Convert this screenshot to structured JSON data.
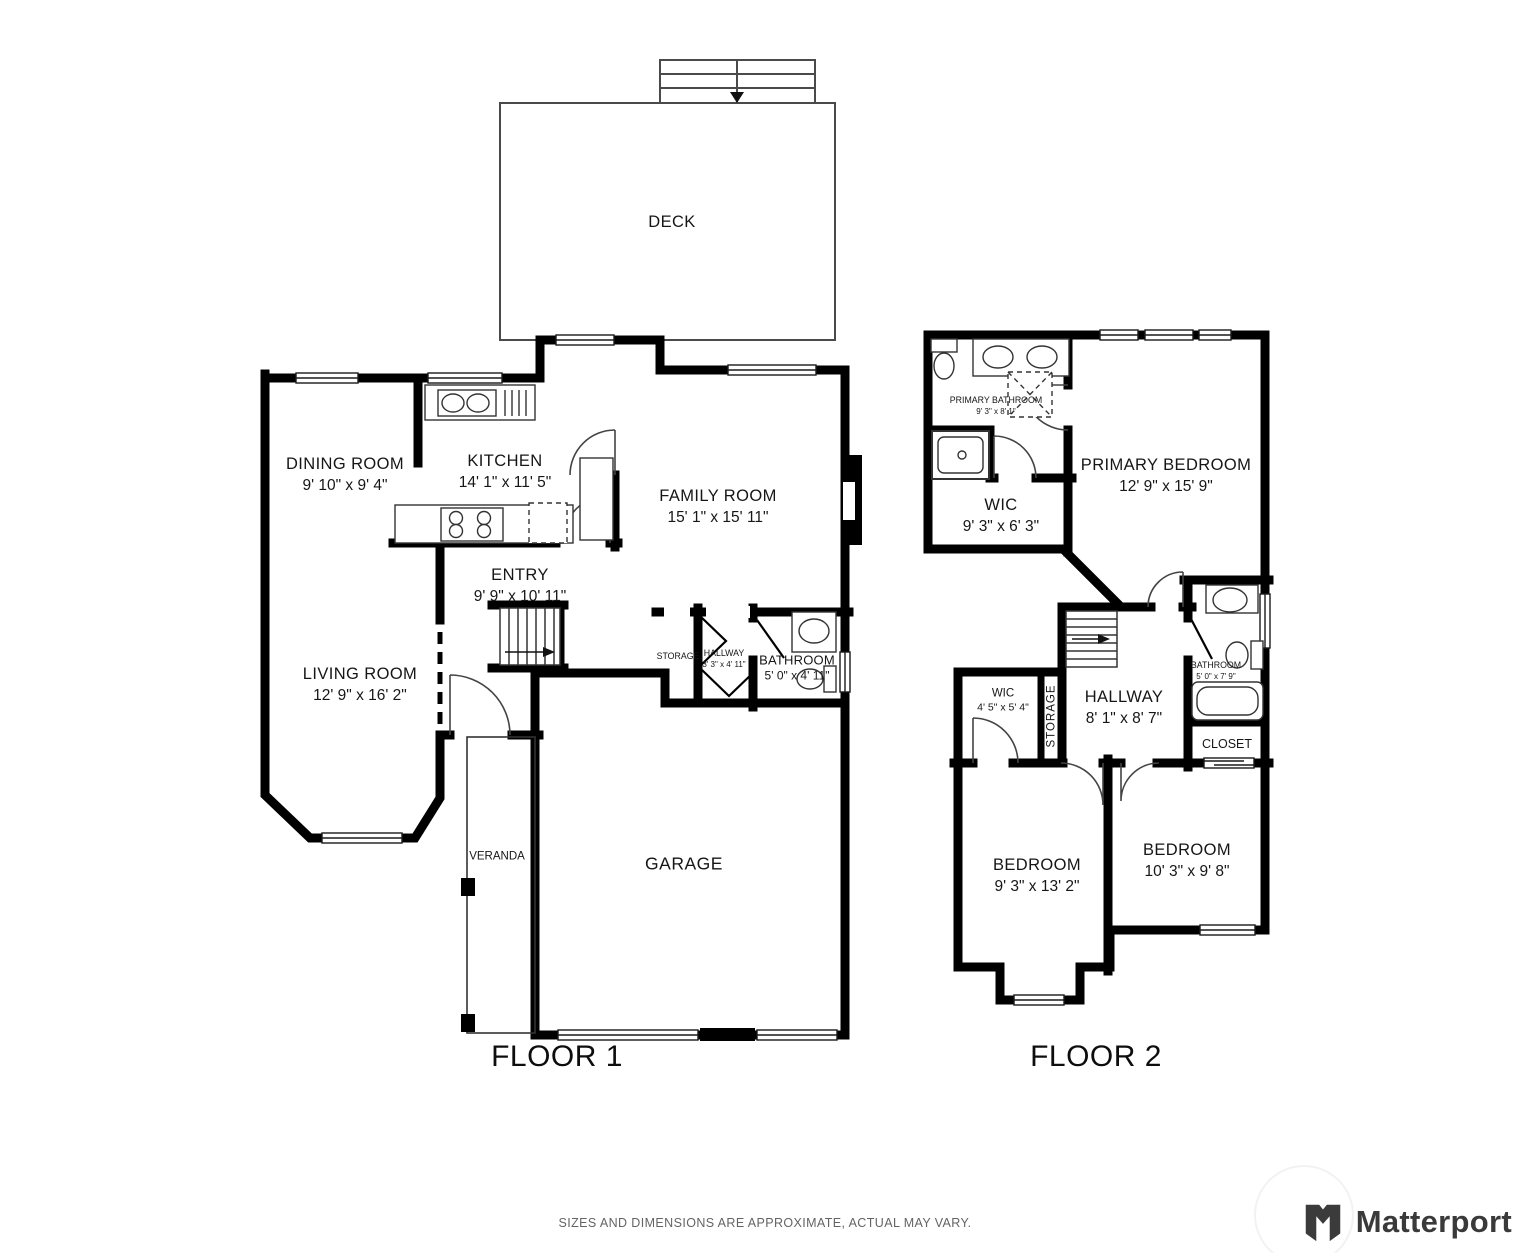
{
  "meta": {
    "disclaimer": "SIZES AND DIMENSIONS ARE APPROXIMATE, ACTUAL MAY VARY.",
    "brand": "Matterport",
    "wall_color": "#000000",
    "background_color": "#ffffff",
    "label_color": "#161616",
    "disclaimer_color": "#646464"
  },
  "floor1": {
    "title": "FLOOR 1",
    "rooms": {
      "deck": {
        "name": "DECK",
        "dims": ""
      },
      "dining": {
        "name": "DINING ROOM",
        "dims": "9' 10\" x 9' 4\""
      },
      "kitchen": {
        "name": "KITCHEN",
        "dims": "14' 1\" x 11' 5\""
      },
      "family": {
        "name": "FAMILY ROOM",
        "dims": "15' 1\" x 15' 11\""
      },
      "entry": {
        "name": "ENTRY",
        "dims": "9' 9\" x 10' 11\""
      },
      "living": {
        "name": "LIVING ROOM",
        "dims": "12' 9\" x 16' 2\""
      },
      "storage": {
        "name": "STORAGE",
        "dims": ""
      },
      "hallway": {
        "name": "HALLWAY",
        "dims": "3' 3\" x 4' 11\""
      },
      "bathroom": {
        "name": "BATHROOM",
        "dims": "5' 0\" x 4' 11\""
      },
      "veranda": {
        "name": "VERANDA",
        "dims": ""
      },
      "garage": {
        "name": "GARAGE",
        "dims": ""
      }
    }
  },
  "floor2": {
    "title": "FLOOR 2",
    "rooms": {
      "primary_bathroom": {
        "name": "PRIMARY BATHROOM",
        "dims": "9' 3\" x 8' 1\""
      },
      "primary_bedroom": {
        "name": "PRIMARY BEDROOM",
        "dims": "12' 9\" x 15' 9\""
      },
      "wic_large": {
        "name": "WIC",
        "dims": "9' 3\" x 6' 3\""
      },
      "wic_small": {
        "name": "WIC",
        "dims": "4' 5\" x 5' 4\""
      },
      "storage": {
        "name": "STORAGE",
        "dims": ""
      },
      "hallway": {
        "name": "HALLWAY",
        "dims": "8' 1\" x 8' 7\""
      },
      "bathroom": {
        "name": "BATHROOM",
        "dims": "5' 0\" x 7' 9\""
      },
      "closet": {
        "name": "CLOSET",
        "dims": ""
      },
      "bedroom_left": {
        "name": "BEDROOM",
        "dims": "9' 3\" x 13' 2\""
      },
      "bedroom_right": {
        "name": "BEDROOM",
        "dims": "10' 3\" x 9' 8\""
      }
    }
  }
}
